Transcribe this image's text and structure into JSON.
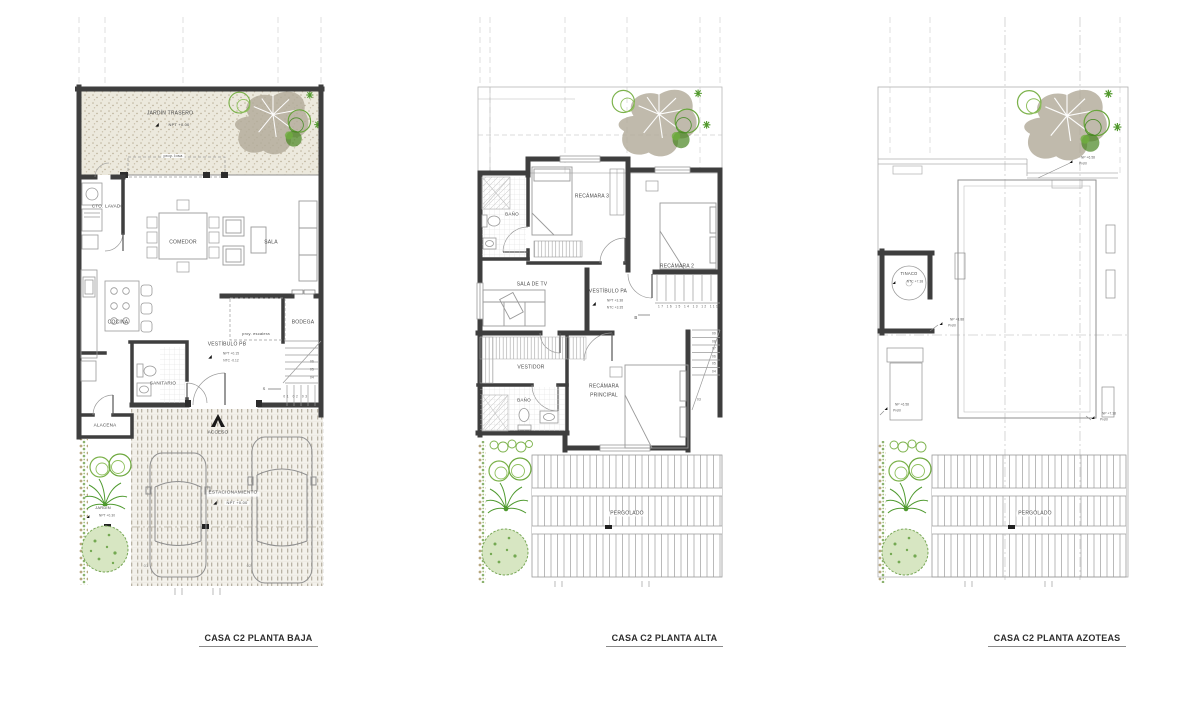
{
  "icons": {
    "level_marker": "◢"
  },
  "plans": {
    "baja": {
      "title": "CASA C2 PLANTA BAJA",
      "labels": {
        "jardin_trasero": "JARDÍN TRASERO",
        "jardin_trasero_npt": "NPT +0.00",
        "proy_losa": "proy. losa",
        "cto_lavado": "CTO. LAVADO",
        "comedor": "COMEDOR",
        "sala": "SALA",
        "cocina": "COCINA",
        "bodega": "BODEGA",
        "proy_escalera": "proy. escalera",
        "vestibulo_pb": "VESTÍBULO PB",
        "vestibulo_npt": "NPT +0.15",
        "vestibulo_ntc": "NTC -0.12",
        "sanitario": "SANITARIO",
        "alacena": "ALACENA",
        "acceso": "ACCESO",
        "estacionamiento": "ESTACIONAMIENTO",
        "estacionamiento_npt": "NPT +0.00",
        "jardin": "JARDÍN",
        "jardin_npt": "NPT +0.30",
        "step_06": "06",
        "step_05": "05",
        "step_04": "04",
        "steps_01_03": "01 02 03",
        "stair_s": "S",
        "spot_01": "01",
        "spot_02": "02"
      }
    },
    "alta": {
      "title": "CASA C2 PLANTA ALTA",
      "labels": {
        "bano_recamaras": "BAÑO",
        "recamara_3": "RECÁMARA 3",
        "recamara_2": "RECÁMARA 2",
        "sala_tv": "SALA DE TV",
        "vestibulo_pa": "VESTÍBULO PA",
        "vestibulo_npt": "NPT +3.38",
        "vestibulo_ntc": "NTC +3.35",
        "steps_17_11": "17 16 15 14 13 12 11",
        "step_10": "10",
        "stair_b": "B",
        "step_09": "09",
        "step_08": "08",
        "step_07": "07",
        "step_06": "06",
        "step_05": "05",
        "step_04": "04",
        "step_03": "03",
        "vestidor": "VESTIDOR",
        "bano_principal": "BAÑO",
        "recamara_ppal_1": "RECÁMARA",
        "recamara_ppal_2": "PRINCIPAL",
        "pergolado": "PERGOLADO"
      }
    },
    "azoteas": {
      "title": "CASA C2 PLANTA AZOTEAS",
      "labels": {
        "np_sup": "NP +6.58",
        "pretil_sup": "Pretil",
        "tinaco": "TINACO",
        "tinaco_ntc": "NTC +7.38",
        "np_tinaco": "NP +8.88",
        "pretil_tinaco": "Pretil",
        "np_izq": "NP +6.58",
        "pretil_izq": "Pretil",
        "np_der": "NP +7.38",
        "pretil_der": "Pretil",
        "pergolado": "PERGOLADO"
      }
    }
  }
}
